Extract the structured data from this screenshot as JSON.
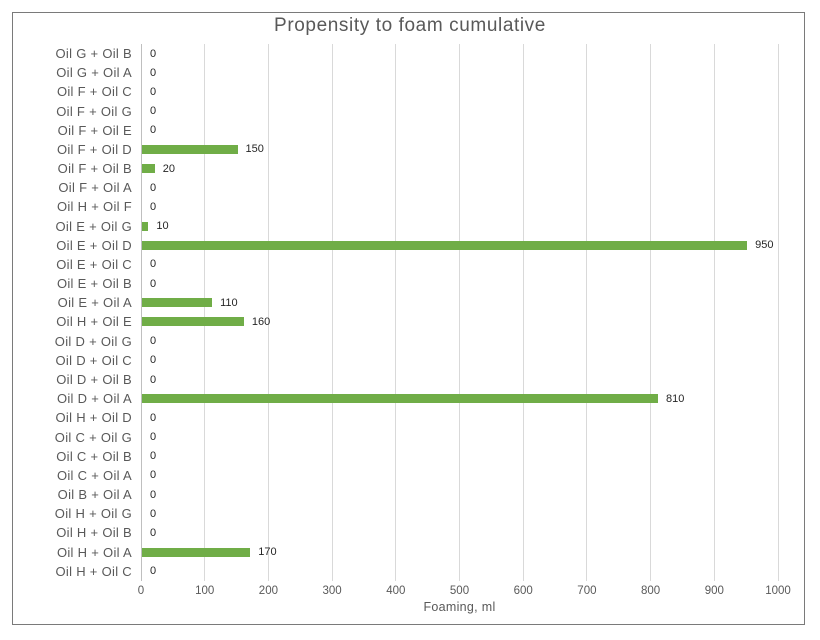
{
  "chart_data": {
    "type": "bar",
    "orientation": "horizontal",
    "title": "Propensity to foam cumulative",
    "xlabel": "Foaming, ml",
    "ylabel": "",
    "xlim": [
      0,
      1000
    ],
    "x_ticks": [
      0,
      100,
      200,
      300,
      400,
      500,
      600,
      700,
      800,
      900,
      1000
    ],
    "grid": true,
    "legend": false,
    "data_labels": true,
    "categories": [
      "Oil G + Oil B",
      "Oil G + Oil A",
      "Oil F + Oil C",
      "Oil F + Oil G",
      "Oil F + Oil E",
      "Oil F + Oil D",
      "Oil F + Oil B",
      "Oil F + Oil A",
      "Oil H + Oil F",
      "Oil E + Oil G",
      "Oil E + Oil D",
      "Oil E + Oil C",
      "Oil E + Oil B",
      "Oil E + Oil A",
      "Oil H + Oil E",
      "Oil D + Oil G",
      "Oil D + Oil C",
      "Oil D + Oil B",
      "Oil D + Oil A",
      "Oil H + Oil D",
      "Oil C + Oil G",
      "Oil C + Oil B",
      "Oil C + Oil A",
      "Oil B + Oil A",
      "Oil H + Oil G",
      "Oil H + Oil B",
      "Oil H + Oil A",
      "Oil H + Oil C"
    ],
    "values": [
      0,
      0,
      0,
      0,
      0,
      150,
      20,
      0,
      0,
      10,
      950,
      0,
      0,
      110,
      160,
      0,
      0,
      0,
      810,
      0,
      0,
      0,
      0,
      0,
      0,
      0,
      170,
      0
    ]
  },
  "colors": {
    "bar": "#70ad47",
    "title_text": "#595959",
    "axis_text": "#595959",
    "value_text": "#262626",
    "gridline": "#d9d9d9",
    "axis_line": "#bfbfbf",
    "chart_border": "#7a7a7a",
    "background": "#ffffff"
  }
}
